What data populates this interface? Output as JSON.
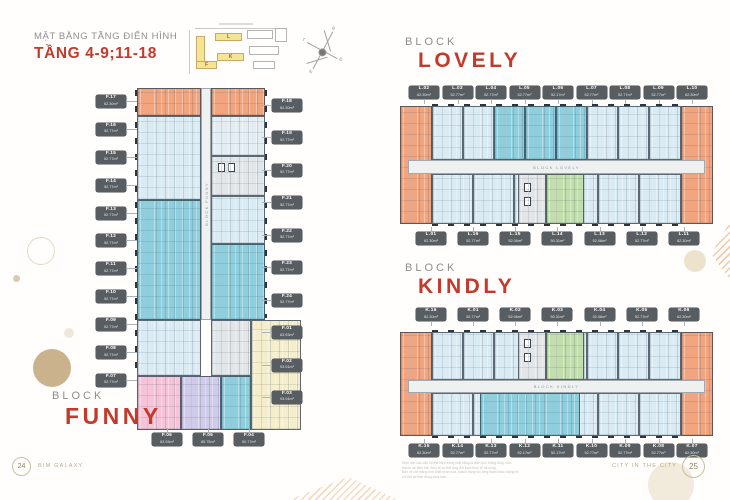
{
  "header": {
    "title": "MẶT BẰNG TẦNG ĐIỂN HÌNH",
    "floors": "TẦNG 4-9;11-18"
  },
  "site_map": {
    "blocks": [
      {
        "label": "F"
      },
      {
        "label": "L"
      },
      {
        "label": "K"
      }
    ]
  },
  "compass": {
    "n": "B",
    "e": "Đ",
    "s": "N",
    "w": "T"
  },
  "blocks": {
    "funny": {
      "kicker": "BLOCK",
      "name": "FUNNY",
      "corridor_label": "BLOCK FUNNY",
      "left_units": [
        {
          "code": "F.17",
          "area": "62.30m²"
        },
        {
          "code": "F.16",
          "area": "52.77m²"
        },
        {
          "code": "F.15",
          "area": "52.77m²"
        },
        {
          "code": "F.14",
          "area": "52.77m²"
        },
        {
          "code": "F.13",
          "area": "52.77m²"
        },
        {
          "code": "F.12",
          "area": "52.77m²"
        },
        {
          "code": "F.11",
          "area": "52.77m²"
        },
        {
          "code": "F.10",
          "area": "52.77m²"
        },
        {
          "code": "F.09",
          "area": "52.77m²"
        },
        {
          "code": "F.08",
          "area": "52.77m²"
        },
        {
          "code": "F.07",
          "area": "52.77m²"
        }
      ],
      "right_units": [
        {
          "code": "F.18",
          "area": "62.30m²"
        },
        {
          "code": "F.19",
          "area": "52.77m²"
        },
        {
          "code": "F.20",
          "area": "52.77m²"
        },
        {
          "code": "F.21",
          "area": "52.77m²"
        },
        {
          "code": "F.22",
          "area": "52.77m²"
        },
        {
          "code": "F.23",
          "area": "52.77m²"
        },
        {
          "code": "F.24",
          "area": "52.77m²"
        },
        {
          "code": "F.01",
          "area": "63.93m²"
        },
        {
          "code": "F.02",
          "area": "93.01m²"
        },
        {
          "code": "F.03",
          "area": "93.04m²"
        }
      ],
      "bottom_units": [
        {
          "code": "F.06",
          "area": "63.93m²"
        },
        {
          "code": "F.05",
          "area": "85.75m²"
        },
        {
          "code": "F.04",
          "area": "50.77m²"
        }
      ]
    },
    "lovely": {
      "kicker": "BLOCK",
      "name": "LOVELY",
      "corridor_label": "BLOCK LOVELY",
      "top_units": [
        {
          "code": "L.02",
          "area": "62.30m²"
        },
        {
          "code": "L.03",
          "area": "52.77m²"
        },
        {
          "code": "L.04",
          "area": "52.77m²"
        },
        {
          "code": "L.05",
          "area": "52.77m²"
        },
        {
          "code": "L.06",
          "area": "52.17m²"
        },
        {
          "code": "L.07",
          "area": "52.77m²"
        },
        {
          "code": "L.08",
          "area": "52.77m²"
        },
        {
          "code": "L.09",
          "area": "52.77m²"
        },
        {
          "code": "L.10",
          "area": "62.30m²"
        }
      ],
      "bottom_units": [
        {
          "code": "L.01",
          "area": "62.30m²"
        },
        {
          "code": "L.16",
          "area": "52.77m²"
        },
        {
          "code": "L.15",
          "area": "52.06m²"
        },
        {
          "code": "L.14",
          "area": "50.31m²"
        },
        {
          "code": "L.13",
          "area": "52.06m²"
        },
        {
          "code": "L.12",
          "area": "52.77m²"
        },
        {
          "code": "L.11",
          "area": "62.30m²"
        }
      ]
    },
    "kindly": {
      "kicker": "BLOCK",
      "name": "KINDLY",
      "corridor_label": "BLOCK KINDLY",
      "top_units": [
        {
          "code": "K.16",
          "area": "62.30m²"
        },
        {
          "code": "K.01",
          "area": "52.77m²"
        },
        {
          "code": "K.02",
          "area": "52.06m²"
        },
        {
          "code": "K.03",
          "area": "50.31m²"
        },
        {
          "code": "K.04",
          "area": "52.06m²"
        },
        {
          "code": "K.05",
          "area": "52.77m²"
        },
        {
          "code": "K.06",
          "area": "62.30m²"
        }
      ],
      "bottom_units": [
        {
          "code": "K.15",
          "area": "62.30m²"
        },
        {
          "code": "K.14",
          "area": "52.77m²"
        },
        {
          "code": "K.13",
          "area": "52.77m²"
        },
        {
          "code": "K.12",
          "area": "52.17m²"
        },
        {
          "code": "K.11",
          "area": "52.17m²"
        },
        {
          "code": "K.10",
          "area": "52.77m²"
        },
        {
          "code": "K.09",
          "area": "52.77m²"
        },
        {
          "code": "K.08",
          "area": "52.77m²"
        },
        {
          "code": "K.07",
          "area": "62.30m²"
        }
      ]
    }
  },
  "footer": {
    "page_left": "24",
    "brand_left": "BIM GALAXY",
    "disclaimer_line1": "Diện tích các căn hộ thể hiện trong mặt bằng là diện tích thông thủy, kích thước và diện tích thực tế có thể thay đổi theo thực tế thi công.",
    "disclaimer_line2": "Bản vẽ chỉ mang tính chất minh họa, khách hàng vui lòng tham khảo thông tin chi tiết tại hợp đồng mua bán.",
    "brand_right": "CITY IN THE CITY",
    "page_right": "25"
  },
  "colors": {
    "accent_red": "#C23A2C",
    "unit_orange": "#F2A47E",
    "unit_lightblue": "#DAEBF4",
    "unit_teal": "#8FCFDD",
    "unit_green": "#C2DEAC",
    "unit_pink": "#F6C3D8",
    "unit_lavender": "#CFCBE9",
    "unit_cream": "#F5EECC",
    "badge_gray": "#585D61",
    "beige": "#C9B28C",
    "sitemap_yellow": "#F4E594"
  }
}
